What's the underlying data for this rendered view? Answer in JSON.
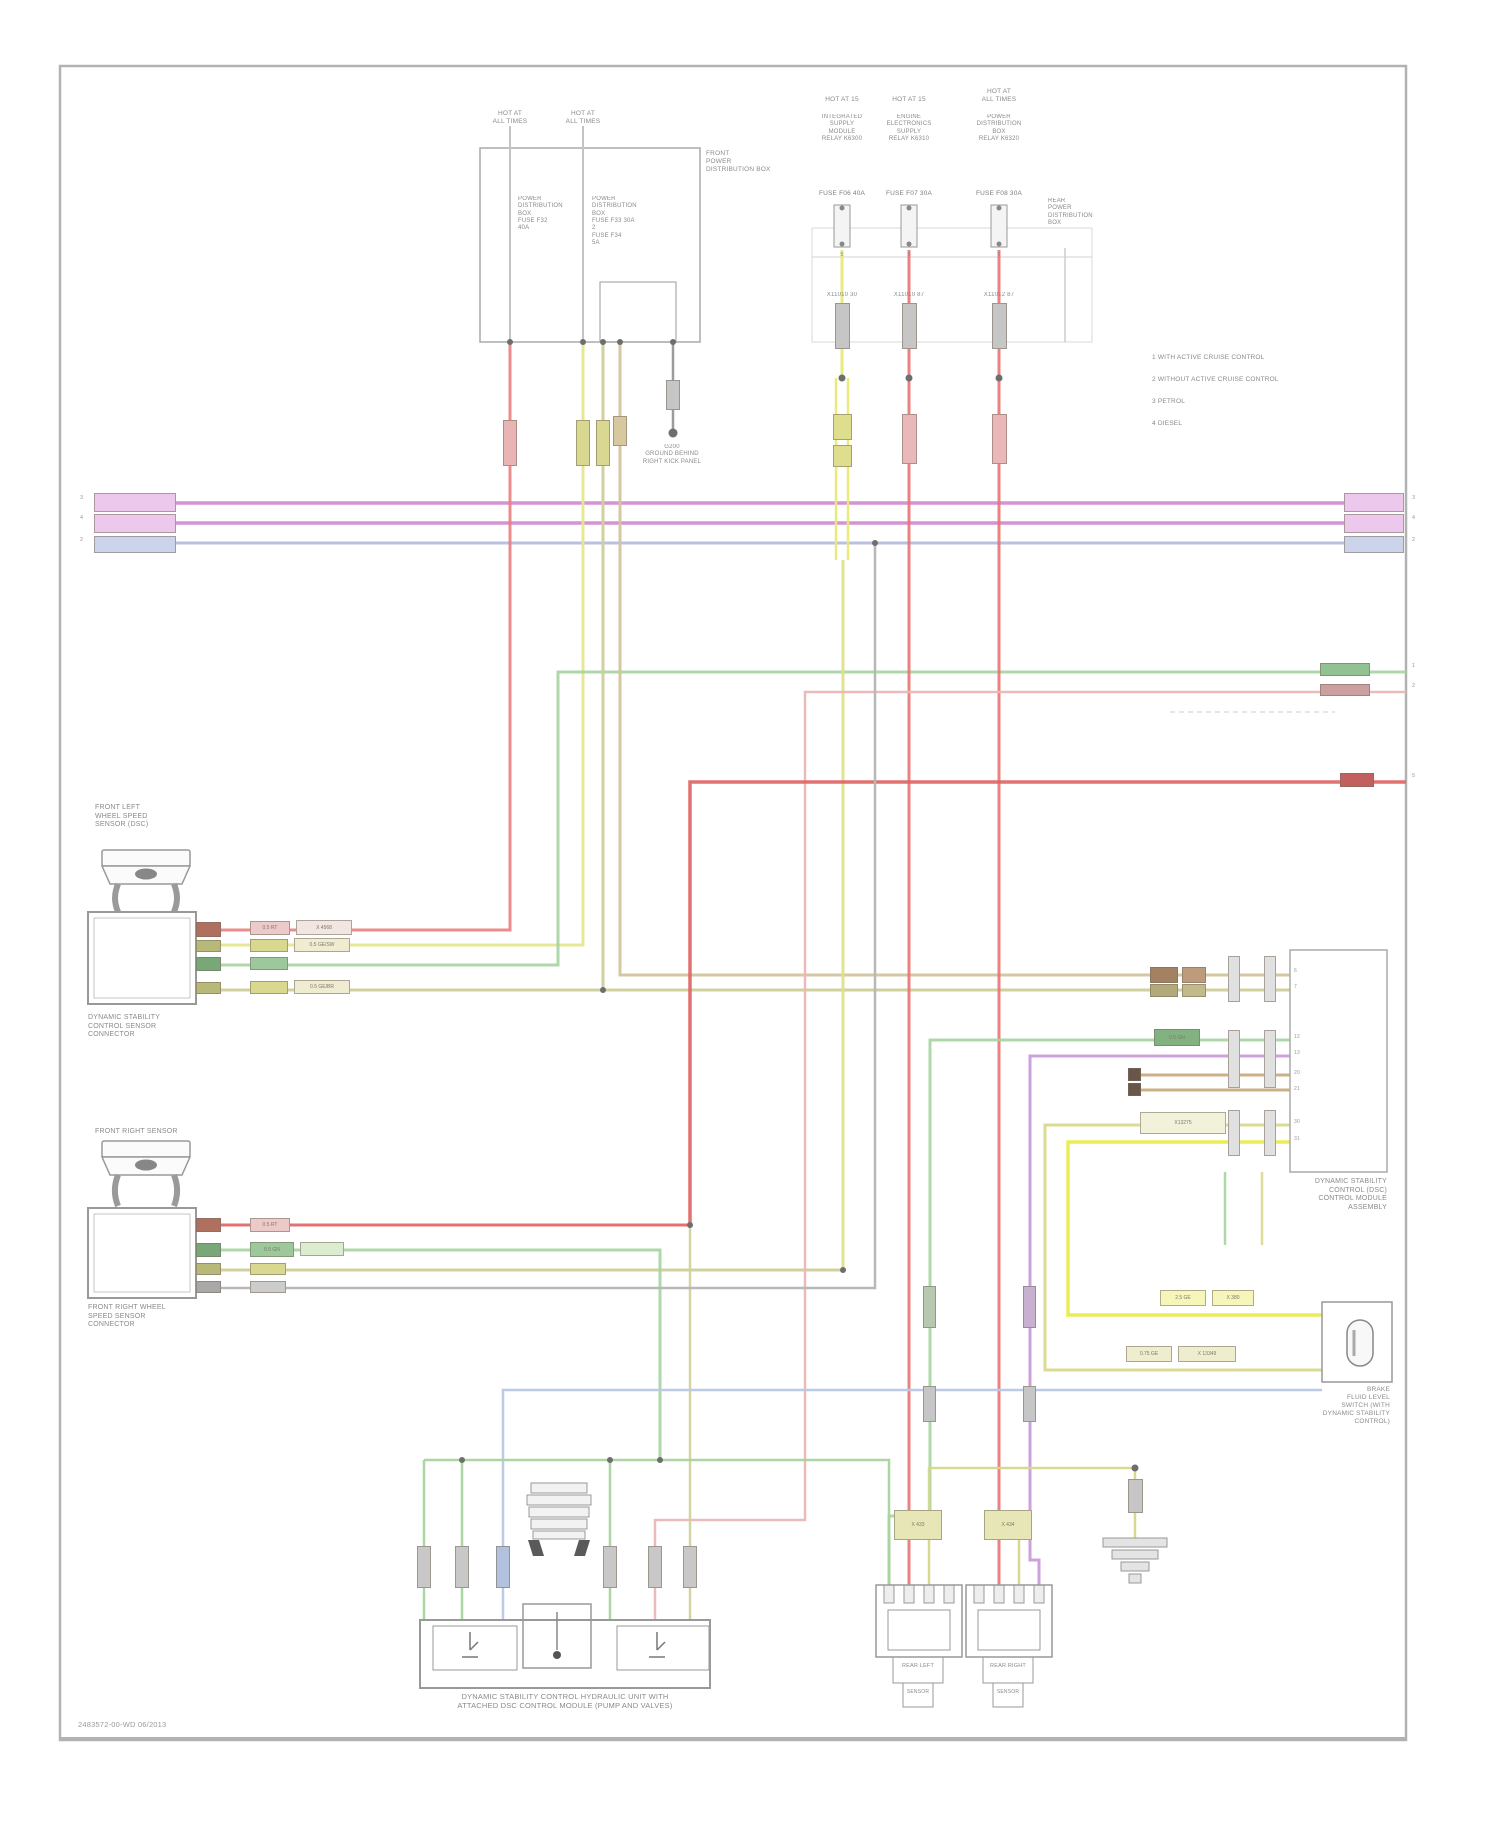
{
  "doc": {
    "type": "automotive wiring diagram page",
    "footer_code": "2483572-00-WD   06/2013"
  },
  "palette": {
    "frame_gray": "#b0b0b0",
    "wire_magenta": "#d493d4",
    "wire_lavender": "#b9c0e2",
    "wire_red": "#e87474",
    "wire_red_bright": "#e06565",
    "wire_pink": "#ecb6b6",
    "wire_yellow_bright": "#ebeb4e",
    "wire_yellow": "#e6e692",
    "wire_khaki": "#cfcf9b",
    "wire_tan": "#d4c49e",
    "wire_brown": "#c8a878",
    "wire_green": "#a6d49e",
    "wire_violet": "#c897d8",
    "wire_blue": "#b8c8e4",
    "wire_gray": "#9c9c9c",
    "text_gray": "#8a8a8a"
  },
  "legend": {
    "rows": [
      {
        "sym": "1",
        "text": "WITH ACTIVE CRUISE CONTROL"
      },
      {
        "sym": "2",
        "text": "WITHOUT ACTIVE CRUISE CONTROL"
      },
      {
        "sym": "3",
        "text": "PETROL"
      },
      {
        "sym": "4",
        "text": "DIESEL"
      }
    ]
  },
  "labels": [
    {
      "n": "fuse1-header",
      "t": "HOT AT\nALL TIMES",
      "x": 470,
      "y": 110,
      "w": 80,
      "a": "center",
      "s": 6.5
    },
    {
      "n": "fuse2-header",
      "t": "HOT AT\nALL TIMES",
      "x": 543,
      "y": 110,
      "w": 80,
      "a": "center",
      "s": 6.5
    },
    {
      "n": "fusebox-col1",
      "t": "POWER\nDISTRIBUTION\nBOX\nFUSE F32\n40A",
      "x": 518,
      "y": 196,
      "s": 6
    },
    {
      "n": "fusebox-col2",
      "t": "POWER\nDISTRIBUTION\nBOX\nFUSE F33 30A\n2\nFUSE F34\n5A",
      "x": 592,
      "y": 196,
      "s": 6
    },
    {
      "n": "front-power-box-label",
      "t": "FRONT\nPOWER\nDISTRIBUTION BOX",
      "x": 706,
      "y": 150,
      "s": 6.5
    },
    {
      "n": "ground1-label",
      "t": "G200\nGROUND BEHIND\nRIGHT KICK PANEL",
      "x": 602,
      "y": 444,
      "w": 140,
      "a": "center",
      "s": 6
    },
    {
      "n": "relay1-header",
      "t": "HOT AT 15",
      "x": 792,
      "y": 96,
      "w": 100,
      "a": "center",
      "s": 6.5
    },
    {
      "n": "relay1-body",
      "t": "INTEGRATED\nSUPPLY\nMODULE\nRELAY K6300",
      "x": 792,
      "y": 114,
      "w": 100,
      "a": "center",
      "s": 6
    },
    {
      "n": "relay1-fuse",
      "t": "FUSE F06 40A",
      "x": 792,
      "y": 190,
      "w": 100,
      "a": "center",
      "s": 6.5,
      "c": "#7c7c7c"
    },
    {
      "n": "relay1-pin",
      "t": "5",
      "x": 792,
      "y": 252,
      "w": 100,
      "a": "center",
      "s": 5.5
    },
    {
      "n": "relay1-conn",
      "t": "X11010   30",
      "x": 792,
      "y": 292,
      "w": 100,
      "a": "center",
      "s": 6
    },
    {
      "n": "relay2-header",
      "t": "HOT AT 15",
      "x": 859,
      "y": 96,
      "w": 100,
      "a": "center",
      "s": 6.5
    },
    {
      "n": "relay2-body",
      "t": "ENGINE\nELECTRONICS\nSUPPLY\nRELAY K6310",
      "x": 859,
      "y": 114,
      "w": 100,
      "a": "center",
      "s": 6
    },
    {
      "n": "relay2-fuse",
      "t": "FUSE F07 30A",
      "x": 859,
      "y": 190,
      "w": 100,
      "a": "center",
      "s": 6.5,
      "c": "#7c7c7c"
    },
    {
      "n": "relay2-pin",
      "t": "3",
      "x": 859,
      "y": 252,
      "w": 100,
      "a": "center",
      "s": 5.5
    },
    {
      "n": "relay2-conn",
      "t": "X11010   87",
      "x": 859,
      "y": 292,
      "w": 100,
      "a": "center",
      "s": 6
    },
    {
      "n": "relay3-header",
      "t": "HOT AT\nALL TIMES",
      "x": 949,
      "y": 88,
      "w": 100,
      "a": "center",
      "s": 6.5
    },
    {
      "n": "relay3-body",
      "t": "POWER\nDISTRIBUTION\nBOX\nRELAY K6320",
      "x": 949,
      "y": 114,
      "w": 100,
      "a": "center",
      "s": 6
    },
    {
      "n": "relay3-fuse",
      "t": "FUSE F08 30A",
      "x": 949,
      "y": 190,
      "w": 100,
      "a": "center",
      "s": 6.5,
      "c": "#7c7c7c"
    },
    {
      "n": "relay3-pin",
      "t": "6",
      "x": 949,
      "y": 252,
      "w": 100,
      "a": "center",
      "s": 5.5
    },
    {
      "n": "relay3-conn",
      "t": "X11012   87",
      "x": 949,
      "y": 292,
      "w": 100,
      "a": "center",
      "s": 6
    },
    {
      "n": "rear-power-box-label",
      "t": "REAR\nPOWER\nDISTRIBUTION\nBOX",
      "x": 1048,
      "y": 198,
      "s": 6
    },
    {
      "n": "legend-row-1",
      "t": "1   WITH ACTIVE CRUISE CONTROL",
      "x": 1152,
      "y": 354,
      "s": 6.5
    },
    {
      "n": "legend-row-2",
      "t": "2   WITHOUT ACTIVE CRUISE CONTROL",
      "x": 1152,
      "y": 376,
      "s": 6.5
    },
    {
      "n": "legend-row-3",
      "t": "3   PETROL",
      "x": 1152,
      "y": 398,
      "s": 6.5
    },
    {
      "n": "legend-row-4",
      "t": "4   DIESEL",
      "x": 1152,
      "y": 420,
      "s": 6.5
    },
    {
      "n": "bus-left-conn-1",
      "t": "X1348",
      "x": 100,
      "y": 497,
      "s": 5.5,
      "c": "#8a5a8a"
    },
    {
      "n": "bus-left-conn-2",
      "t": "X1349",
      "x": 100,
      "y": 517,
      "s": 5.5,
      "c": "#8a5a8a"
    },
    {
      "n": "bus-left-conn-3",
      "t": "X1350",
      "x": 100,
      "y": 539,
      "s": 5.5,
      "c": "#5a6a9a"
    },
    {
      "n": "bus-right-conn-1",
      "t": "X1348",
      "x": 1348,
      "y": 497,
      "s": 5.5,
      "c": "#8a5a8a"
    },
    {
      "n": "bus-right-conn-2",
      "t": "X1349",
      "x": 1348,
      "y": 517,
      "s": 5.5,
      "c": "#8a5a8a"
    },
    {
      "n": "bus-right-conn-3",
      "t": "X1350",
      "x": 1348,
      "y": 539,
      "s": 5.5,
      "c": "#5a6a9a"
    },
    {
      "n": "tick-left-1",
      "t": "3",
      "x": 80,
      "y": 495,
      "s": 5.5,
      "c": "#9a9a9a"
    },
    {
      "n": "tick-left-2",
      "t": "4",
      "x": 80,
      "y": 515,
      "s": 5.5,
      "c": "#9a9a9a"
    },
    {
      "n": "tick-left-3",
      "t": "2",
      "x": 80,
      "y": 537,
      "s": 5.5,
      "c": "#9a9a9a"
    },
    {
      "n": "tick-right-1",
      "t": "3",
      "x": 1412,
      "y": 495,
      "s": 5.5,
      "c": "#9a9a9a"
    },
    {
      "n": "tick-right-2",
      "t": "4",
      "x": 1412,
      "y": 515,
      "s": 5.5,
      "c": "#9a9a9a"
    },
    {
      "n": "tick-right-3",
      "t": "2",
      "x": 1412,
      "y": 537,
      "s": 5.5,
      "c": "#9a9a9a"
    },
    {
      "n": "tick-right-4",
      "t": "1",
      "x": 1412,
      "y": 663,
      "s": 5.5,
      "c": "#9a9a9a"
    },
    {
      "n": "tick-right-5",
      "t": "2",
      "x": 1412,
      "y": 683,
      "s": 5.5,
      "c": "#9a9a9a"
    },
    {
      "n": "tick-right-6",
      "t": "5",
      "x": 1412,
      "y": 773,
      "s": 5.5,
      "c": "#9a9a9a"
    },
    {
      "n": "sensor1-top-label",
      "t": "FRONT LEFT\nWHEEL SPEED\nSENSOR (DSC)",
      "x": 95,
      "y": 804,
      "s": 7
    },
    {
      "n": "sensor1-bottom-label",
      "t": "DYNAMIC STABILITY\nCONTROL SENSOR\nCONNECTOR",
      "x": 88,
      "y": 1014,
      "s": 7
    },
    {
      "n": "sensor2-top-label",
      "t": "FRONT RIGHT SENSOR",
      "x": 95,
      "y": 1128,
      "s": 7
    },
    {
      "n": "sensor2-bottom-label",
      "t": "FRONT RIGHT WHEEL\nSPEED SENSOR\nCONNECTOR",
      "x": 88,
      "y": 1304,
      "s": 7
    },
    {
      "n": "dsc-module-label",
      "t": "DYNAMIC STABILITY\nCONTROL (DSC)\nCONTROL MODULE\nASSEMBLY",
      "x": 1237,
      "y": 1178,
      "w": 150,
      "a": "right",
      "s": 7
    },
    {
      "n": "brake-switch-label",
      "t": "BRAKE\nFLUID LEVEL\nSWITCH (WITH\nDYNAMIC STABILITY\nCONTROL)",
      "x": 1240,
      "y": 1386,
      "w": 150,
      "a": "right",
      "s": 6.5
    },
    {
      "n": "hydraulic-unit-label",
      "t": "DYNAMIC STABILITY CONTROL HYDRAULIC UNIT WITH\nATTACHED DSC CONTROL MODULE (PUMP AND VALVES)",
      "x": 365,
      "y": 1692,
      "w": 400,
      "a": "center",
      "s": 7.5
    },
    {
      "n": "rear-left-sensor-label",
      "t": "REAR LEFT",
      "x": 893,
      "y": 1663,
      "w": 50,
      "a": "center",
      "s": 5.5
    },
    {
      "n": "rear-left-sensor-label2",
      "t": "SENSOR",
      "x": 903,
      "y": 1689,
      "w": 30,
      "a": "center",
      "s": 5
    },
    {
      "n": "rear-right-sensor-label",
      "t": "REAR RIGHT",
      "x": 983,
      "y": 1663,
      "w": 50,
      "a": "center",
      "s": 5.5
    },
    {
      "n": "rear-right-sensor-label2",
      "t": "SENSOR",
      "x": 993,
      "y": 1689,
      "w": 30,
      "a": "center",
      "s": 5
    },
    {
      "n": "module-pin-6",
      "t": "6",
      "x": 1294,
      "y": 968,
      "s": 5,
      "c": "#999999"
    },
    {
      "n": "module-pin-7",
      "t": "7",
      "x": 1294,
      "y": 984,
      "s": 5,
      "c": "#999999"
    },
    {
      "n": "module-pin-12",
      "t": "12",
      "x": 1294,
      "y": 1034,
      "s": 5,
      "c": "#999999"
    },
    {
      "n": "module-pin-13",
      "t": "13",
      "x": 1294,
      "y": 1050,
      "s": 5,
      "c": "#999999"
    },
    {
      "n": "module-pin-20",
      "t": "20",
      "x": 1294,
      "y": 1070,
      "s": 5,
      "c": "#999999"
    },
    {
      "n": "module-pin-21",
      "t": "21",
      "x": 1294,
      "y": 1086,
      "s": 5,
      "c": "#999999"
    },
    {
      "n": "module-pin-30",
      "t": "30",
      "x": 1294,
      "y": 1119,
      "s": 5,
      "c": "#999999"
    },
    {
      "n": "module-pin-31",
      "t": "31",
      "x": 1294,
      "y": 1136,
      "s": 5,
      "c": "#999999"
    },
    {
      "n": "footer-code",
      "t": "2483572-00-WD   06/2013",
      "x": 78,
      "y": 1720,
      "s": 7.5,
      "c": "#9a9a9a"
    }
  ],
  "chips": [
    {
      "n": "conn-chip",
      "x": 503,
      "y": 420,
      "w": 14,
      "h": 46,
      "f": "#e8b4b4"
    },
    {
      "n": "conn-chip",
      "x": 576,
      "y": 420,
      "w": 14,
      "h": 46,
      "f": "#d8d890"
    },
    {
      "n": "conn-chip",
      "x": 596,
      "y": 420,
      "w": 14,
      "h": 46,
      "f": "#d8d890"
    },
    {
      "n": "conn-chip",
      "x": 613,
      "y": 416,
      "w": 14,
      "h": 30,
      "f": "#d8c8a0"
    },
    {
      "n": "conn-chip",
      "x": 666,
      "y": 380,
      "w": 14,
      "h": 30,
      "f": "#c6c6c6"
    },
    {
      "n": "conn-chip",
      "x": 835,
      "y": 303,
      "w": 15,
      "h": 46,
      "f": "#c6c6c6"
    },
    {
      "n": "conn-chip",
      "x": 902,
      "y": 303,
      "w": 15,
      "h": 46,
      "f": "#c6c6c6"
    },
    {
      "n": "conn-chip",
      "x": 992,
      "y": 303,
      "w": 15,
      "h": 46,
      "f": "#c6c6c6"
    },
    {
      "n": "conn-chip",
      "x": 833,
      "y": 414,
      "w": 19,
      "h": 26,
      "f": "#dede8e"
    },
    {
      "n": "conn-chip",
      "x": 833,
      "y": 445,
      "w": 19,
      "h": 22,
      "f": "#dede8e"
    },
    {
      "n": "conn-chip",
      "x": 902,
      "y": 414,
      "w": 15,
      "h": 50,
      "f": "#eab8b8"
    },
    {
      "n": "conn-chip",
      "x": 992,
      "y": 414,
      "w": 15,
      "h": 50,
      "f": "#eab8b8"
    },
    {
      "n": "pin-chip",
      "x": 196,
      "y": 922,
      "w": 25,
      "h": 15,
      "f": "#b07060"
    },
    {
      "n": "pin-chip",
      "x": 196,
      "y": 940,
      "w": 25,
      "h": 12,
      "f": "#b8b878"
    },
    {
      "n": "pin-chip",
      "x": 196,
      "y": 957,
      "w": 25,
      "h": 14,
      "f": "#78a878"
    },
    {
      "n": "pin-chip",
      "x": 196,
      "y": 982,
      "w": 25,
      "h": 12,
      "f": "#b8b878"
    },
    {
      "n": "wire-label",
      "x": 250,
      "y": 921,
      "w": 40,
      "h": 14,
      "f": "#eccaca",
      "t": "0.5 RT"
    },
    {
      "n": "wire-label",
      "x": 296,
      "y": 920,
      "w": 56,
      "h": 15,
      "f": "#f2e6e2",
      "t": "X 4568"
    },
    {
      "n": "wire-label",
      "x": 250,
      "y": 939,
      "w": 38,
      "h": 13,
      "f": "#d8d890"
    },
    {
      "n": "wire-label",
      "x": 294,
      "y": 938,
      "w": 56,
      "h": 14,
      "f": "#efecd2",
      "t": "0.5 GE/SW"
    },
    {
      "n": "wire-label",
      "x": 250,
      "y": 957,
      "w": 38,
      "h": 13,
      "f": "#9cc89c"
    },
    {
      "n": "wire-label",
      "x": 250,
      "y": 981,
      "w": 38,
      "h": 13,
      "f": "#d8d890"
    },
    {
      "n": "wire-label",
      "x": 294,
      "y": 980,
      "w": 56,
      "h": 14,
      "f": "#efecd2",
      "t": "0.5 GE/BR"
    },
    {
      "n": "pin-chip",
      "x": 196,
      "y": 1218,
      "w": 25,
      "h": 14,
      "f": "#b07060"
    },
    {
      "n": "pin-chip",
      "x": 196,
      "y": 1243,
      "w": 25,
      "h": 14,
      "f": "#78a878"
    },
    {
      "n": "pin-chip",
      "x": 196,
      "y": 1263,
      "w": 25,
      "h": 12,
      "f": "#b8b878"
    },
    {
      "n": "pin-chip",
      "x": 196,
      "y": 1281,
      "w": 25,
      "h": 12,
      "f": "#a8a8a8"
    },
    {
      "n": "wire-label",
      "x": 250,
      "y": 1218,
      "w": 40,
      "h": 14,
      "f": "#eccaca",
      "t": "0.5 RT"
    },
    {
      "n": "wire-label",
      "x": 250,
      "y": 1242,
      "w": 44,
      "h": 15,
      "f": "#9cc89c",
      "t": "0.5 GN"
    },
    {
      "n": "wire-label",
      "x": 300,
      "y": 1242,
      "w": 44,
      "h": 14,
      "f": "#dcecd0"
    },
    {
      "n": "wire-label",
      "x": 250,
      "y": 1263,
      "w": 36,
      "h": 12,
      "f": "#d8d890"
    },
    {
      "n": "wire-label",
      "x": 250,
      "y": 1281,
      "w": 36,
      "h": 12,
      "f": "#cccccc"
    },
    {
      "n": "wire-label",
      "x": 1150,
      "y": 967,
      "w": 28,
      "h": 16,
      "f": "#a28262"
    },
    {
      "n": "wire-label",
      "x": 1182,
      "y": 967,
      "w": 24,
      "h": 16,
      "f": "#bc9c7c"
    },
    {
      "n": "wire-label",
      "x": 1150,
      "y": 984,
      "w": 28,
      "h": 13,
      "f": "#b2aa7a"
    },
    {
      "n": "wire-label",
      "x": 1182,
      "y": 984,
      "w": 24,
      "h": 13,
      "f": "#c2ba8a"
    },
    {
      "n": "wire-label",
      "x": 1154,
      "y": 1029,
      "w": 46,
      "h": 17,
      "f": "#82b282",
      "t": "0.5 GN"
    },
    {
      "n": "shield-terminal",
      "x": 1128,
      "y": 1068,
      "w": 13,
      "h": 13,
      "f": "#6a5648"
    },
    {
      "n": "shield-terminal",
      "x": 1128,
      "y": 1083,
      "w": 13,
      "h": 13,
      "f": "#6a5648"
    },
    {
      "n": "pin-slab",
      "x": 1228,
      "y": 956,
      "w": 12,
      "h": 46,
      "f": "#e0e0e0"
    },
    {
      "n": "pin-slab",
      "x": 1264,
      "y": 956,
      "w": 12,
      "h": 46,
      "f": "#e0e0e0"
    },
    {
      "n": "pin-slab",
      "x": 1228,
      "y": 1030,
      "w": 12,
      "h": 58,
      "f": "#e0e0e0"
    },
    {
      "n": "pin-slab",
      "x": 1264,
      "y": 1030,
      "w": 12,
      "h": 58,
      "f": "#e0e0e0"
    },
    {
      "n": "pin-slab",
      "x": 1228,
      "y": 1110,
      "w": 12,
      "h": 46,
      "f": "#e0e0e0"
    },
    {
      "n": "pin-slab",
      "x": 1264,
      "y": 1110,
      "w": 12,
      "h": 46,
      "f": "#e0e0e0"
    },
    {
      "n": "wire-label",
      "x": 1140,
      "y": 1112,
      "w": 86,
      "h": 22,
      "f": "#f2f2da",
      "t": "X13275"
    },
    {
      "n": "wire-label",
      "x": 1160,
      "y": 1290,
      "w": 46,
      "h": 16,
      "f": "#f6f6ba",
      "t": "2.5 GE"
    },
    {
      "n": "wire-label",
      "x": 1212,
      "y": 1290,
      "w": 42,
      "h": 16,
      "f": "#f6f6ba",
      "t": "X 380"
    },
    {
      "n": "wire-label",
      "x": 1126,
      "y": 1346,
      "w": 46,
      "h": 16,
      "f": "#eeeecf",
      "t": "0.75 GE"
    },
    {
      "n": "wire-label",
      "x": 1178,
      "y": 1346,
      "w": 58,
      "h": 16,
      "f": "#eeeecf",
      "t": "X 13349"
    },
    {
      "n": "conn-chip",
      "x": 923,
      "y": 1286,
      "w": 13,
      "h": 42,
      "f": "#b8c8b0"
    },
    {
      "n": "conn-chip",
      "x": 923,
      "y": 1386,
      "w": 13,
      "h": 36,
      "f": "#c6c6c6"
    },
    {
      "n": "conn-chip",
      "x": 1023,
      "y": 1286,
      "w": 13,
      "h": 42,
      "f": "#c8b0d0"
    },
    {
      "n": "conn-chip",
      "x": 1023,
      "y": 1386,
      "w": 13,
      "h": 36,
      "f": "#c6c6c6"
    },
    {
      "n": "conn-chip",
      "x": 417,
      "y": 1546,
      "w": 14,
      "h": 42,
      "f": "#c8c8c8"
    },
    {
      "n": "conn-chip",
      "x": 455,
      "y": 1546,
      "w": 14,
      "h": 42,
      "f": "#c8c8c8"
    },
    {
      "n": "conn-chip",
      "x": 496,
      "y": 1546,
      "w": 14,
      "h": 42,
      "f": "#b2c2de"
    },
    {
      "n": "conn-chip",
      "x": 603,
      "y": 1546,
      "w": 14,
      "h": 42,
      "f": "#c8c8c8"
    },
    {
      "n": "conn-chip",
      "x": 648,
      "y": 1546,
      "w": 14,
      "h": 42,
      "f": "#c8c8c8"
    },
    {
      "n": "conn-chip",
      "x": 683,
      "y": 1546,
      "w": 14,
      "h": 42,
      "f": "#c8c8c8"
    },
    {
      "n": "wire-label",
      "x": 894,
      "y": 1510,
      "w": 48,
      "h": 30,
      "f": "#e6e6b6",
      "t": "X 433"
    },
    {
      "n": "wire-label",
      "x": 984,
      "y": 1510,
      "w": 48,
      "h": 30,
      "f": "#e6e6b6",
      "t": "X 434"
    },
    {
      "n": "conn-chip",
      "x": 1128,
      "y": 1479,
      "w": 15,
      "h": 34,
      "f": "#c6c6c6"
    },
    {
      "n": "wire-label",
      "x": 1320,
      "y": 663,
      "w": 50,
      "h": 13,
      "f": "#92c292"
    },
    {
      "n": "wire-label",
      "x": 1320,
      "y": 684,
      "w": 50,
      "h": 12,
      "f": "#caa0a0"
    },
    {
      "n": "wire-label",
      "x": 1340,
      "y": 773,
      "w": 34,
      "h": 14,
      "f": "#c26060"
    },
    {
      "n": "bus-connector",
      "x": 94,
      "y": 493,
      "w": 82,
      "h": 19,
      "f": "#ecc9ec"
    },
    {
      "n": "bus-connector",
      "x": 94,
      "y": 514,
      "w": 82,
      "h": 19,
      "f": "#ecc9ec"
    },
    {
      "n": "bus-connector",
      "x": 94,
      "y": 536,
      "w": 82,
      "h": 17,
      "f": "#ccd4ec"
    },
    {
      "n": "bus-connector",
      "x": 1344,
      "y": 493,
      "w": 60,
      "h": 19,
      "f": "#ecc9ec"
    },
    {
      "n": "bus-connector",
      "x": 1344,
      "y": 514,
      "w": 60,
      "h": 19,
      "f": "#ecc9ec"
    },
    {
      "n": "bus-connector",
      "x": 1344,
      "y": 536,
      "w": 60,
      "h": 17,
      "f": "#ccd4ec"
    }
  ]
}
